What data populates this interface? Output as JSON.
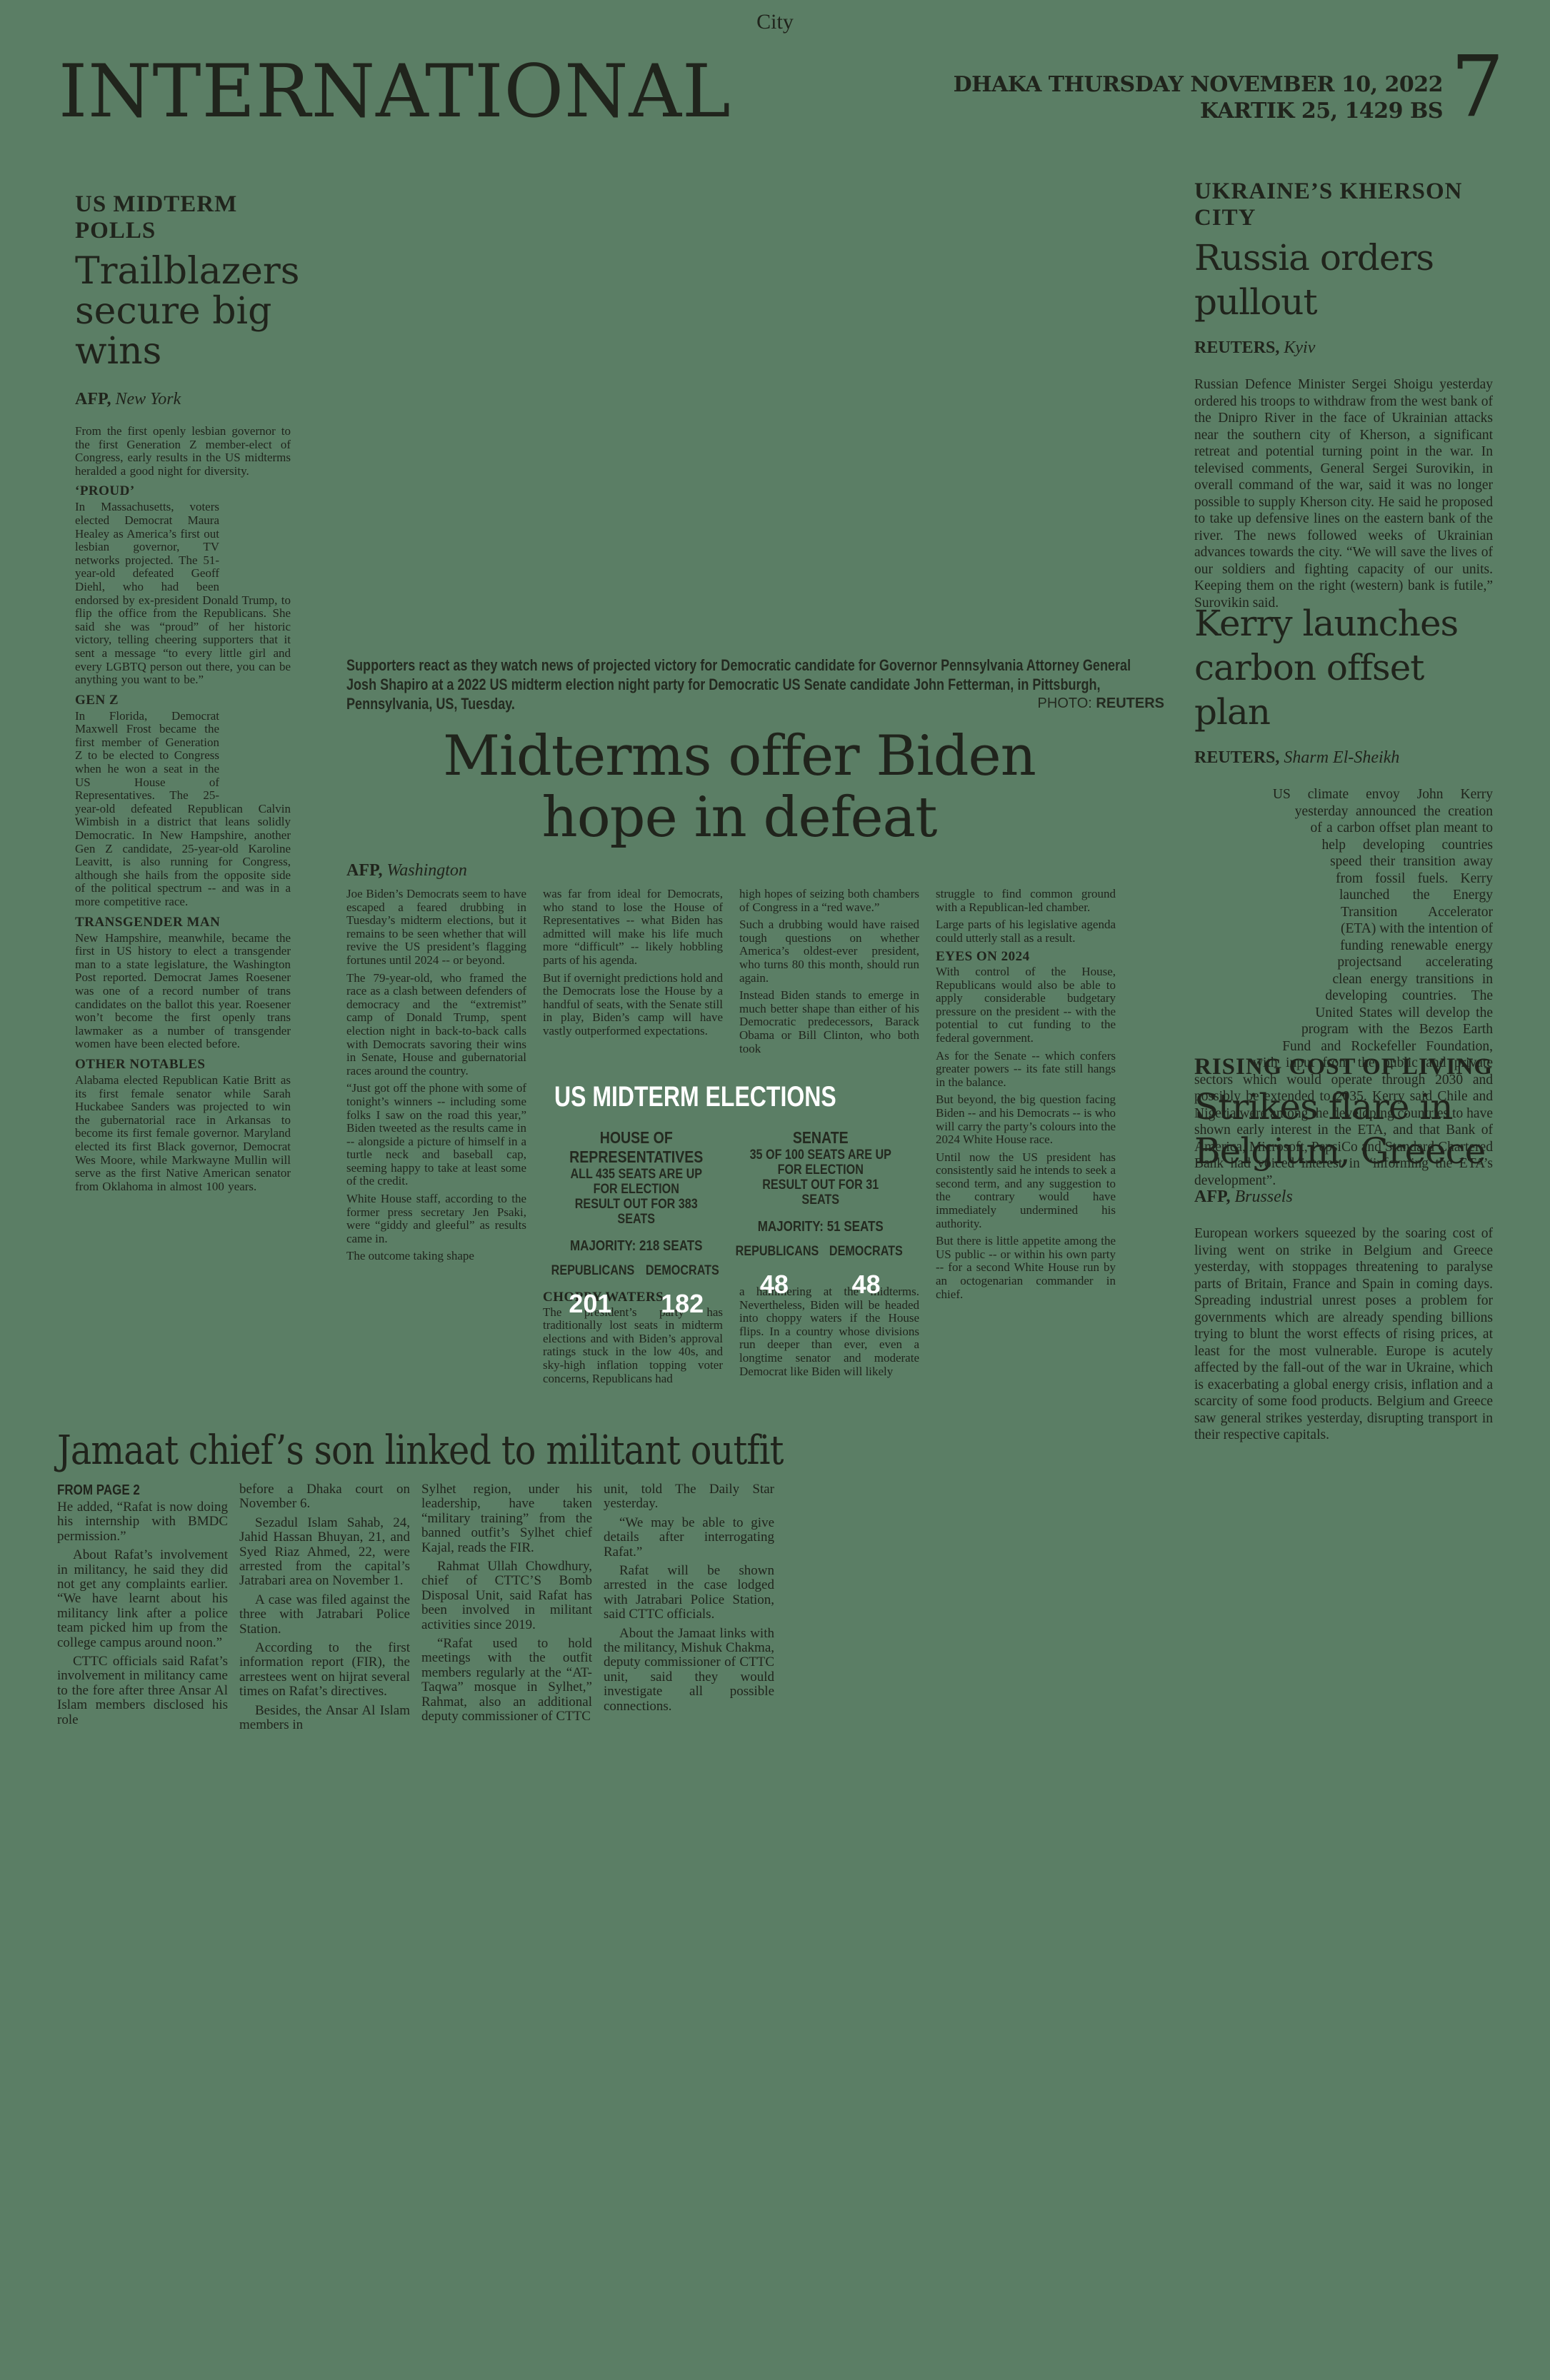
{
  "header": {
    "section_label": "City",
    "masthead": "INTERNATIONAL",
    "date_line1": "DHAKA THURSDAY NOVEMBER 10, 2022",
    "date_line2": "KARTIK 25, 1429 BS",
    "page_number": "7"
  },
  "colors": {
    "background": "#5b7e65",
    "ink": "#20241c",
    "white": "#ffffff"
  },
  "trailblazers": {
    "kicker": "US MIDTERM POLLS",
    "headline_lines": [
      "Trailblazers",
      "secure big",
      "wins"
    ],
    "byline_agency": "AFP,",
    "byline_place": "New York",
    "lead": "From the first openly lesbian governor to the first Generation Z member-elect of Congress, early results in the US midterms heralded a good night for diversity.",
    "sections": [
      {
        "heading": "‘PROUD’",
        "text": "In Massachusetts, voters elected Democrat Maura Healey as America’s first out lesbian governor, TV networks projected. The 51-year-old defeated Geoff Diehl, who had been endorsed by ex-president Donald Trump, to flip the office from the Republicans. She said she was “proud” of her historic victory, telling cheering supporters that it sent a message “to every little girl and every LGBTQ person out there, you can be anything you want to be.”"
      },
      {
        "heading": "GEN Z",
        "text": "In Florida, Democrat Maxwell Frost became the first member of Generation Z to be elected to Congress when he won a seat in the US House of Representatives. The 25-year-old defeated Republican Calvin Wimbish in a district that leans solidly Democratic. In New Hampshire, another Gen Z candidate, 25-year-old Karoline Leavitt, is also running for Congress, although she hails from the opposite side of the political spectrum -- and was in a more competitive race."
      },
      {
        "heading": "TRANSGENDER MAN",
        "text": "New Hampshire, meanwhile, became the first in US history to elect a transgender man to a state legislature, the Washington Post reported. Democrat James Roesener was one of a record number of trans candidates on the ballot this year. Roesener won’t become the first openly trans lawmaker as a number of transgender women have been elected before."
      },
      {
        "heading": "OTHER NOTABLES",
        "text": "Alabama elected Republican Katie Britt as its first female senator while Sarah Huckabee Sanders was projected to win the gubernatorial race in Arkansas to become its first female governor. Maryland elected its first Black governor, Democrat Wes Moore, while Markwayne Mullin will serve as the first Native American senator from Oklahoma in almost 100 years."
      }
    ]
  },
  "midterms": {
    "caption": "Supporters react as they watch news of projected victory for Democratic candidate for Governor Pennsylvania Attorney General Josh Shapiro at a 2022 US midterm election night party for Democratic US Senate candidate John Fetterman, in Pittsburgh, Pennsylvania, US, Tuesday.",
    "photo_label": "PHOTO:",
    "photo_credit": "REUTERS",
    "headline_lines": [
      "Midterms offer Biden",
      "hope in defeat"
    ],
    "byline_agency": "AFP,",
    "byline_place": "Washington",
    "col1": [
      "Joe Biden’s Democrats seem to have escaped a feared drubbing in Tuesday’s midterm elections, but it remains to be seen whether that will revive the US president’s flagging fortunes until 2024 -- or beyond.",
      "The 79-year-old, who framed the race as a clash between defenders of democracy and the “extremist” camp of Donald Trump, spent election night in back-to-back calls with Democrats savoring their wins in Senate, House and gubernatorial races around the country.",
      "“Just got off the phone with some of tonight’s winners -- including some folks I saw on the road this year,” Biden tweeted as the results came in -- alongside a picture of himself in a turtle neck and baseball cap, seeming happy to take at least some of the credit.",
      "White House staff, according to the former press secretary Jen Psaki, were “giddy and gleeful” as results came in.",
      "The outcome taking shape"
    ],
    "col2_top": [
      "was far from ideal for Democrats, who stand to lose the House of Representatives -- what Biden has admitted will make his life much more “difficult” -- likely hobbling parts of his agenda.",
      "But if overnight predictions hold and the Democrats lose the House by a handful of seats, with the Senate still in play, Biden’s camp will have vastly outperformed expectations."
    ],
    "col2_heading": "CHOPPY WATERS",
    "col2_bottom": [
      "The president’s party has traditionally lost seats in midterm elections and with Biden’s approval ratings stuck in the low 40s, and sky-high inflation topping voter concerns, Republicans had"
    ],
    "col3_top": [
      "high hopes of seizing both chambers of Congress in a “red wave.”",
      "Such a drubbing would have raised tough questions on whether America’s oldest-ever president, who turns 80 this month, should run again.",
      "Instead Biden stands to emerge in much better shape than either of his Democratic predecessors, Barack Obama or Bill Clinton, who both took"
    ],
    "col3_bottom": [
      "a hammering at the midterms. Nevertheless, Biden will be headed into choppy waters if the House flips. In a country whose divisions run deeper than ever, even a longtime senator and moderate Democrat like Biden will likely"
    ],
    "col4_top": [
      "struggle to find common ground with a Republican-led chamber.",
      "Large parts of his legislative agenda could utterly stall as a result."
    ],
    "col4_heading": "EYES ON 2024",
    "col4_bottom": [
      "With control of the House, Republicans would also be able to apply considerable budgetary pressure on the president -- with the potential to cut funding to the federal government.",
      "As for the Senate -- which confers greater powers -- its fate still hangs in the balance.",
      "But beyond, the big question facing Biden -- and his Democrats -- is who will carry the party’s colours into the 2024 White House race.",
      "Until now the US president has consistently said he intends to seek a second term, and any suggestion to the contrary would have immediately undermined his authority.",
      "But there is little appetite among the US public -- or within his own party -- for a second White House run by an octogenarian commander in chief."
    ]
  },
  "infographic": {
    "title": "US MIDTERM ELECTIONS",
    "rep_label": "REPUBLICANS",
    "dem_label": "DEMOCRATS",
    "house": {
      "heading": "HOUSE OF REPRESENTATIVES",
      "line1": "ALL 435 SEATS ARE UP FOR ELECTION",
      "line2": "RESULT OUT FOR 383 SEATS",
      "majority": "MAJORITY: 218 SEATS",
      "rep": "201",
      "dem": "182"
    },
    "senate": {
      "heading": "SENATE",
      "line1": "35 OF 100 SEATS ARE UP FOR ELECTION",
      "line2": "RESULT OUT FOR 31 SEATS",
      "majority": "MAJORITY: 51 SEATS",
      "rep": "48",
      "dem": "48"
    }
  },
  "kherson": {
    "kicker": "UKRAINE’S KHERSON CITY",
    "headline_lines": [
      "Russia orders",
      "pullout"
    ],
    "byline_agency": "REUTERS,",
    "byline_place": "Kyiv",
    "body": "Russian Defence Minister Sergei Shoigu yesterday ordered his troops to withdraw from the west bank of the Dnipro River in the face of Ukrainian attacks near the southern city of Kherson, a significant retreat and potential turning point in the war. In televised comments, General Sergei Surovikin, in overall command of the war, said it was no longer possible to supply Kherson city. He said he proposed to take up defensive lines on the eastern bank of the river. The news followed weeks of Ukrainian advances towards the city. “We will save the lives of our soldiers and fighting capacity of our units. Keeping them on the right (western) bank is futile,” Surovikin said."
  },
  "kerry": {
    "headline_lines": [
      "Kerry launches",
      "carbon offset plan"
    ],
    "byline_agency": "REUTERS,",
    "byline_place": "Sharm El-Sheikh",
    "body": "US climate envoy John Kerry yesterday announced the creation of a carbon offset plan meant to help developing countries speed their transition away from fossil fuels. Kerry launched the Energy Transition Accelerator (ETA) with the intention of funding renewable energy projectsand accelerating clean energy transitions in developing countries. The United States will develop the program with the Bezos Earth Fund and Rockefeller Foundation, with input from the public and private sectors which would operate through 2030 and possibly be extended to 2035. Kerry said Chile and Nigeria were among the developing countries to have shown early interest in the ETA, and that Bank of America, Microsoft, PepsiCo and Standard Chartered Bank had voiced interest in “informing the ETA’s development”."
  },
  "strikes": {
    "kicker": "RISING COST OF LIVING",
    "headline_lines": [
      "Strikes flare in",
      "Belgium, Greece"
    ],
    "byline_agency": "AFP,",
    "byline_place": "Brussels",
    "body": "European workers squeezed by the soaring cost of living went on strike in Belgium and Greece yesterday, with stoppages threatening to paralyse parts of Britain, France and Spain in coming days. Spreading industrial unrest poses a problem for governments which are already spending billions trying to blunt the worst effects of rising prices, at least for the most vulnerable. Europe is acutely affected by the fall-out of the war in Ukraine, which is exacerbating a global energy crisis, inflation and a scarcity of some food products. Belgium and Greece saw general strikes yesterday, disrupting transport in their respective capitals."
  },
  "jamaat": {
    "headline": "Jamaat chief’s son linked to militant outfit",
    "from_page": "FROM PAGE 2",
    "col1": [
      "He added, “Rafat is now doing his internship with BMDC permission.”",
      "About Rafat’s involvement in militancy, he said they did not get any complaints earlier. “We have learnt about his militancy link after a police team picked him up from the college campus around noon.”",
      "CTTC officials said Rafat’s involvement in militancy came to the fore after three Ansar Al Islam members disclosed his role"
    ],
    "col2": [
      "before a Dhaka court on November 6.",
      "Sezadul Islam Sahab, 24, Jahid Hassan Bhuyan, 21, and Syed Riaz Ahmed, 22, were arrested from the capital’s Jatrabari area on November 1.",
      "A case was filed against the three with Jatrabari Police Station.",
      "According to the first information report (FIR), the arrestees went on hijrat several times on Rafat’s directives.",
      "Besides, the Ansar Al Islam members in"
    ],
    "col3": [
      "Sylhet region, under his leadership, have taken “military training” from the banned outfit’s Sylhet chief Kajal, reads the FIR.",
      "Rahmat Ullah Chowdhury, chief of CTTC’S Bomb Disposal Unit, said Rafat has been involved in militant activities since 2019.",
      "“Rafat used to hold meetings with the outfit members regularly at the “AT- Taqwa” mosque in Sylhet,” Rahmat, also an additional deputy commissioner of CTTC"
    ],
    "col4": [
      "unit, told The Daily Star yesterday.",
      "“We may be able to give details after interrogating Rafat.”",
      "Rafat will be shown arrested in the case lodged with Jatrabari Police Station, said CTTC officials.",
      "About the Jamaat links with the militancy, Mishuk Chakma, deputy commissioner of CTTC unit, said they would investigate all possible connections."
    ]
  }
}
